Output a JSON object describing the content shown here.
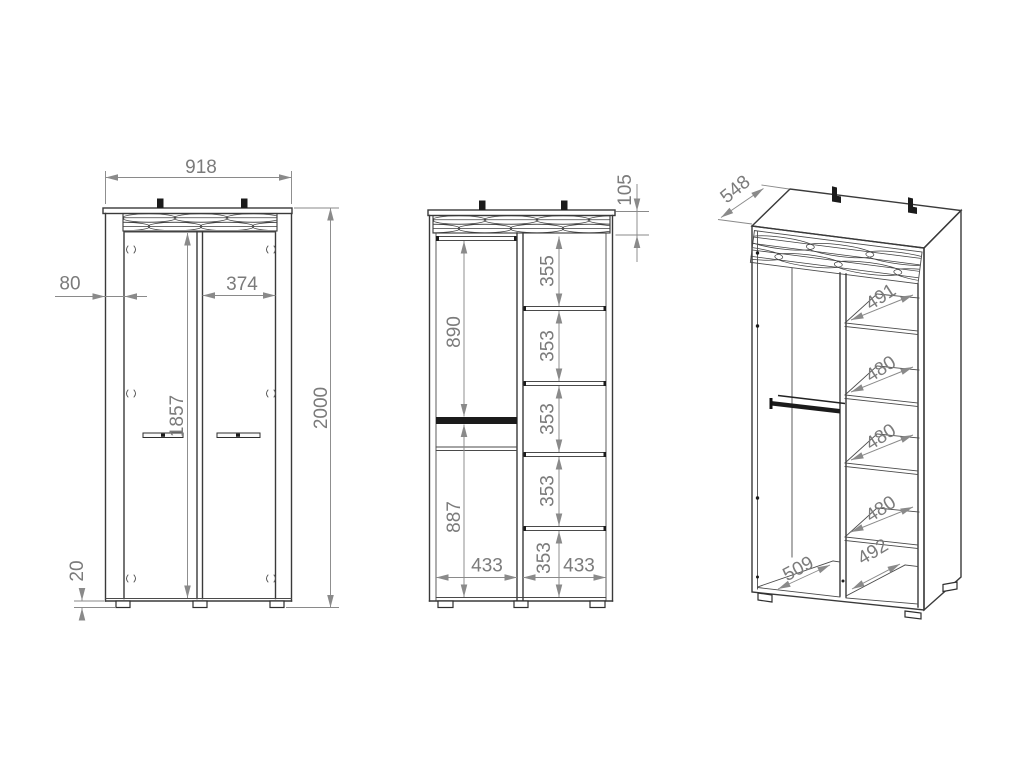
{
  "drawing": {
    "front_view": {
      "overall_width": "918",
      "side_offset": "80",
      "door_width": "374",
      "door_height": "1857",
      "overall_height": "2000",
      "plinth_height": "20"
    },
    "open_view": {
      "strip_height": "105",
      "shelf_gaps": [
        "355",
        "353",
        "353",
        "353",
        "353"
      ],
      "hanging_section": "890",
      "lower_section": "887",
      "left_compartment_width": "433",
      "right_compartment_width": "433"
    },
    "side_view": {
      "depth": "548",
      "shelf_depths": [
        "491",
        "480",
        "480",
        "480"
      ],
      "right_floor_depth": "492",
      "left_floor_depth": "509"
    }
  },
  "colors": {
    "background": "#ffffff",
    "outline": "#3a3a3a",
    "dimension_line": "#8a8a8a",
    "dimension_text": "#7b7b7b",
    "hardware": "#1b1b1b"
  }
}
